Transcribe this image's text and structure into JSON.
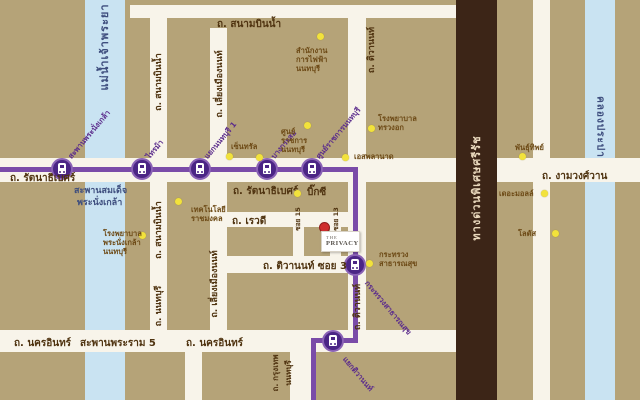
{
  "colors": {
    "background": "#b5a378",
    "road": "#f8f4ea",
    "water": "#c9e3f2",
    "expressway": "#3c2517",
    "mrt_line": "#7a4ba8",
    "mrt_station": "#4b2585",
    "landmark_dot": "#f2e23c",
    "project_dot": "#cf2e2e",
    "road_label": "#4f3310",
    "mrt_label": "#5b2c8c",
    "water_label": "#3e4e7e"
  },
  "water": {
    "river": "แม่น้ำเจ้าพระยา",
    "canal": "คลองประปา"
  },
  "expressway_label": "ทางด่วนพิเศษศรีรัช",
  "roads": {
    "sanambinnam_top": "ถ. สนามบินน้ำ",
    "sanambinnam_vertical": "ถ. สนามบินน้ำ",
    "sanambinnam_vertical_south": "ถ. สนามบินน้ำ",
    "nonthaburi_vertical": "ถ. นนทบุรี",
    "liang_mueang_nont_north": "ถ. เลี่ยงเมืองนนท์",
    "liang_mueang_nont_south": "ถ. เลี่ยงเมืองนนท์",
    "rattanathibet_west": "ถ. รัตนาธิเบศร์",
    "rattanathibet_mid": "ถ. รัตนาธิเบศร์",
    "ngamwongwan": "ถ. งามวงศ์วาน",
    "rewadee": "ถ. เรวดี",
    "tiwanon_soi_3": "ถ. ติวานนท์ ซอย 3",
    "tiwanon_north": "ถ. ติวานนท์",
    "tiwanon_south": "ถ. ติวานนท์",
    "nakhon_in_west": "ถ. นครอินทร์",
    "nakhon_in_east": "ถ. นครอินทร์",
    "krungthep_line1": "ถ. กรุงเทพ",
    "krungthep_line2": "นนทบุรี",
    "soi_a": "ซอย 15",
    "soi_b": "ซอย 13"
  },
  "bridges": {
    "phra_nangklao_line1": "สะพานสมเด็จ",
    "phra_nangklao_line2": "พระนั่งเกล้า",
    "rama5": "สะพานพระราม 5"
  },
  "stations": [
    {
      "name": "สะพานพระนั่งเกล้า"
    },
    {
      "name": "ไทรม้า"
    },
    {
      "name": "แยกนนทบุรี 1"
    },
    {
      "name": "บางกระสอ"
    },
    {
      "name": "ศูนย์ราชการนนทบุรี"
    },
    {
      "name": "กระทรวงสาธารณสุข"
    },
    {
      "name": "แยกติวานนท์"
    }
  ],
  "landmarks": [
    {
      "id": "electricity-office",
      "lines": [
        "สำนักงาน",
        "การไฟฟ้า",
        "นนทบุรี"
      ]
    },
    {
      "id": "rajamangala-technology",
      "lines": [
        "เทคโนโลยี",
        "ราชมงคล"
      ]
    },
    {
      "id": "phra-nangklao-hospital",
      "lines": [
        "โรงพยาบาล",
        "พระนั่งเกล้า",
        "นนทบุรี"
      ]
    },
    {
      "id": "chest-disease-hospital",
      "lines": [
        "โรงพยาบาล",
        "ทรวงอก"
      ]
    },
    {
      "id": "government-center",
      "lines": [
        "ศูนย์",
        "ราชการ",
        "นนทบุรี"
      ]
    },
    {
      "id": "central",
      "lines": [
        "เซ็นทรัล"
      ]
    },
    {
      "id": "big-c",
      "lines": [
        "บิ๊กซี"
      ]
    },
    {
      "id": "esplanade",
      "lines": [
        "เอสพลานาด"
      ]
    },
    {
      "id": "ministry-public-health",
      "lines": [
        "กระทรวง",
        "สาธารณสุข"
      ]
    },
    {
      "id": "pantip",
      "lines": [
        "พันธุ์ทิพย์"
      ]
    },
    {
      "id": "the-mall",
      "lines": [
        "เดอะมอลล์"
      ]
    },
    {
      "id": "lotus",
      "lines": [
        "โลตัส"
      ]
    }
  ],
  "project": {
    "the": "THE",
    "name": "PRIVACY"
  }
}
